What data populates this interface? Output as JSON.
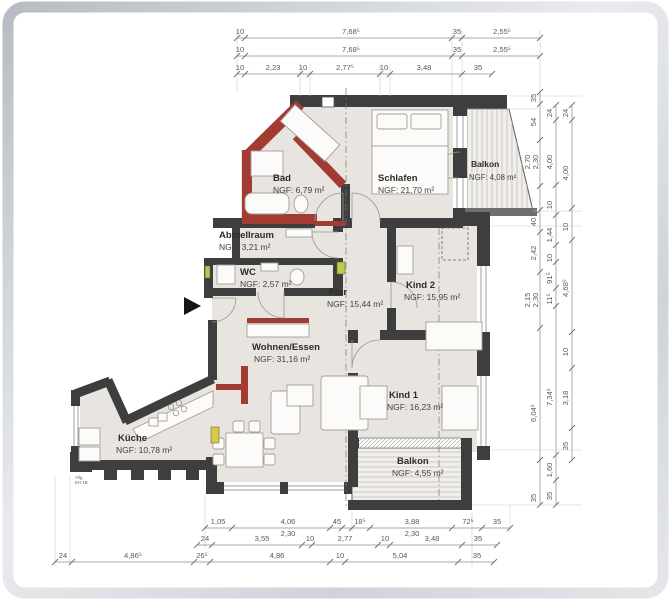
{
  "plan": {
    "rooms": [
      {
        "name": "Bad",
        "area": "NGF: 6,79 m²"
      },
      {
        "name": "Schlafen",
        "area": "NGF: 21,70 m²"
      },
      {
        "name": "Balkon",
        "area": "NGF: 4,08 m²"
      },
      {
        "name": "Abstellraum",
        "area": "NGF: 3,21 m²"
      },
      {
        "name": "WC",
        "area": "NGF: 2,57 m²"
      },
      {
        "name": "Flur",
        "area": "NGF: 15,44 m²"
      },
      {
        "name": "Kind 2",
        "area": "NGF: 15,95 m²"
      },
      {
        "name": "Wohnen/Essen",
        "area": "NGF:  31,16 m²"
      },
      {
        "name": "Kind 1",
        "area": "NGF: 16,23 m²"
      },
      {
        "name": "Küche",
        "area": "NGF: 10,78 m²"
      },
      {
        "name": "Balkon",
        "area": "NGF: 4,55 m²"
      }
    ],
    "annotations": {
      "exit_note_line1": "Allg.",
      "exit_note_line2": "EH 1B"
    }
  },
  "dimensions": {
    "top_row1": [
      "10",
      "7,68⁵",
      "35",
      "2,55⁵"
    ],
    "top_row2": [
      "10",
      "7,68⁵",
      "35",
      "2,55⁵"
    ],
    "top_row3": [
      "10",
      "2,23",
      "10",
      "2,77⁵",
      "10",
      "3,48",
      "35"
    ],
    "bottom_row1": [
      "1,05",
      "4,06",
      "2,30",
      "45",
      "18⁵",
      "3,88",
      "2,30",
      "72⁵",
      "35"
    ],
    "bottom_row2": [
      "24",
      "3,55",
      "10",
      "2,77",
      "10",
      "3,48",
      "35"
    ],
    "bottom_row3": [
      "24",
      "4,86⁵",
      "26⁵",
      "4,86",
      "10",
      "5,04",
      "35"
    ],
    "right_col1": [
      "35",
      "54",
      "2,70",
      "2,30",
      "40",
      "2,42",
      "2,15",
      "2,30",
      "6,04⁵",
      "35"
    ],
    "right_col2": [
      "24",
      "4,00",
      "10",
      "1,44",
      "10",
      "91⁵",
      "11⁵",
      "7,34⁵",
      "1,60",
      "35"
    ],
    "right_col3": [
      "24",
      "4,00",
      "10",
      "4,68⁵",
      "10",
      "3,18",
      "35"
    ]
  },
  "colors": {
    "wall": "#3e3e3e",
    "new_wall_red": "#a23b31",
    "floor": "#e8e4df",
    "balcony_floor": "#f1efeb",
    "dimension_text": "#5a5a5a",
    "frame_silver": "#c2c7ce"
  }
}
